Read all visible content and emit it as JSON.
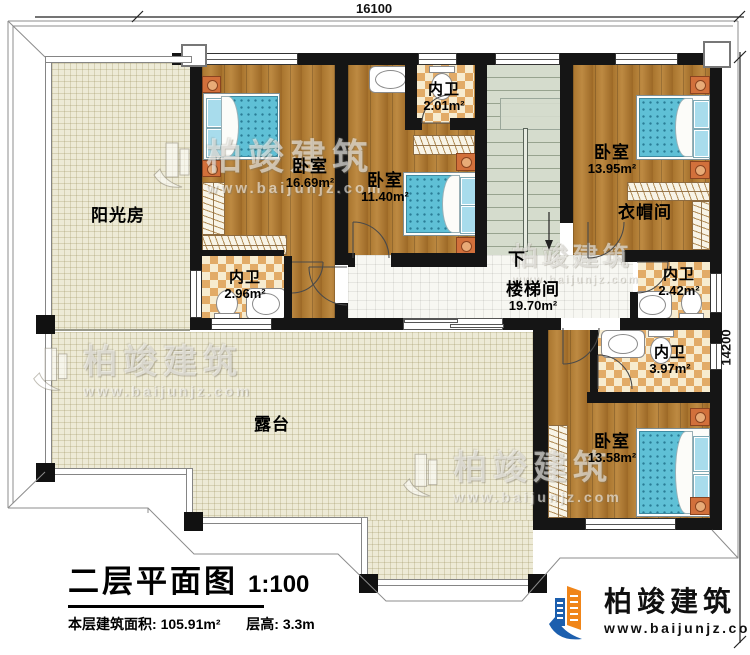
{
  "dimensions": {
    "width_label": "16100",
    "height_label": "14200"
  },
  "rooms": {
    "sunroom": {
      "label": "阳光房"
    },
    "bedroom1": {
      "label": "卧室",
      "area": "16.69m²"
    },
    "bath1": {
      "label": "内卫",
      "area": "2.96m²"
    },
    "bedroom2": {
      "label": "卧室",
      "area": "11.40m²"
    },
    "bath2": {
      "label": "内卫",
      "area": "2.01m²"
    },
    "stairwell": {
      "label": "楼梯间",
      "area": "19.70m²",
      "direction": "下"
    },
    "bedroom3": {
      "label": "卧室",
      "area": "13.95m²"
    },
    "cloakroom": {
      "label": "衣帽间"
    },
    "bath3": {
      "label": "内卫",
      "area": "2.42m²"
    },
    "bath4": {
      "label": "内卫",
      "area": "3.97m²"
    },
    "bedroom4": {
      "label": "卧室",
      "area": "13.58m²"
    },
    "terrace": {
      "label": "露台"
    }
  },
  "title_block": {
    "name": "二层平面图",
    "scale": "1:100",
    "area_label": "本层建筑面积:",
    "area_value": "105.91m²",
    "floor_height_label": "层高:",
    "floor_height_value": "3.3m"
  },
  "brand": {
    "name": "柏竣建筑",
    "url": "www.baijunjz.com"
  },
  "watermark": {
    "text": "柏竣建筑",
    "url": "www.baijunjz.com"
  },
  "colors": {
    "wall": "#151515",
    "wood_floor": "#a9752e",
    "tile_floor": "#edead6",
    "bath_tile": "#e2ab67",
    "stair_floor": "#d5dccd",
    "bed_blue": "#5fc0d6",
    "brand_blue": "#1c5fae",
    "brand_orange": "#f08519"
  }
}
